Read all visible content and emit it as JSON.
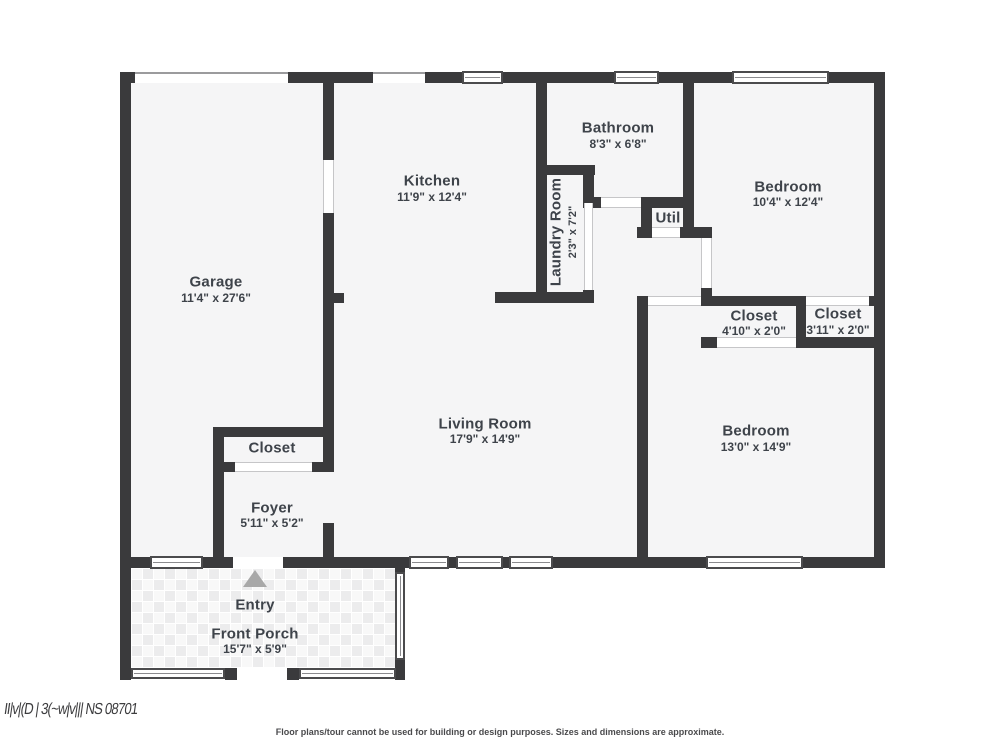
{
  "rooms": {
    "garage": {
      "name": "Garage",
      "dims": "11'4\" x 27'6\""
    },
    "kitchen": {
      "name": "Kitchen",
      "dims": "11'9\" x 12'4\""
    },
    "bathroom": {
      "name": "Bathroom",
      "dims": "8'3\" x 6'8\""
    },
    "laundry": {
      "name": "Laundry Room",
      "dims": "2'3\" x 7'2\""
    },
    "util": {
      "name": "Util"
    },
    "bedroom1": {
      "name": "Bedroom",
      "dims": "10'4\" x 12'4\""
    },
    "closet1": {
      "name": "Closet",
      "dims": "4'10\" x 2'0\""
    },
    "closet2": {
      "name": "Closet",
      "dims": "3'11\" x 2'0\""
    },
    "living": {
      "name": "Living Room",
      "dims": "17'9\" x 14'9\""
    },
    "bedroom2": {
      "name": "Bedroom",
      "dims": "13'0\" x 14'9\""
    },
    "closet3": {
      "name": "Closet"
    },
    "foyer": {
      "name": "Foyer",
      "dims": "5'11\" x 5'2\""
    },
    "entry": {
      "name": "Entry"
    },
    "porch": {
      "name": "Front Porch",
      "dims": "15'7\" x 5'9\""
    }
  },
  "footer": {
    "disclaimer": "Floor plans/tour cannot be used for building or design purposes. Sizes and dimensions are approximate."
  },
  "watermark": {
    "text": "II|v|(D | 3(~w|v||| NS 08701"
  },
  "colors": {
    "wall": "#3a3a3c",
    "floor": "#f5f5f6",
    "label": "#3e434a",
    "entry_arrow": "#a8a8a8"
  }
}
